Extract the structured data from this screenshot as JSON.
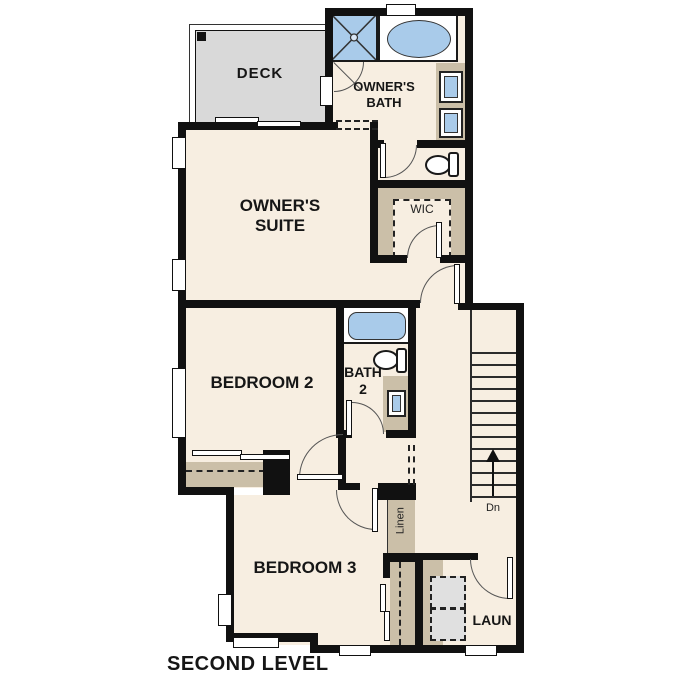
{
  "plan": {
    "level_title": "SECOND LEVEL",
    "labels": {
      "deck": "DECK",
      "owners_bath": [
        "OWNER'S",
        "BATH"
      ],
      "owners_suite": [
        "OWNER'S",
        "SUITE"
      ],
      "wic": "WIC",
      "bedroom2": "BEDROOM 2",
      "bath2": [
        "BATH",
        "2"
      ],
      "stairs_down": "Dn",
      "linen": "Linen",
      "bedroom3": "BEDROOM 3",
      "laundry": "LAUN"
    },
    "colors": {
      "floor": "#f7eee1",
      "wall": "#111111",
      "counter_tan": "#cbbfa8",
      "fixture_blue": "#a9cbea",
      "deck_gray": "#d9d9d9",
      "appliance_gray": "#e0e0e0"
    }
  }
}
